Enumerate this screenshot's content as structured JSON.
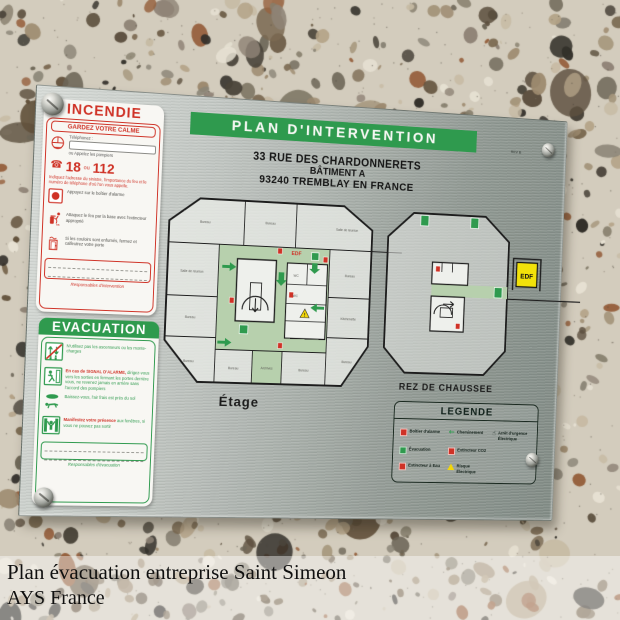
{
  "caption": {
    "line1": "Plan évacuation entreprise Saint Simeon",
    "line2": "AYS France"
  },
  "plate": {
    "title": "PLAN D'INTERVENTION",
    "rev": "REV B",
    "address": {
      "line1": "33 RUE DES CHARDONNERETS",
      "line2": "BÂTIMENT A",
      "line3": "93240 TREMBLAY EN FRANCE"
    },
    "incendie": {
      "title": "INCENDIE",
      "subtitle": "GARDEZ VOTRE CALME",
      "phone_label": "Téléphonez :",
      "phone_value": "",
      "call_label": "ou Appelez les pompiers",
      "num1": "18",
      "num_sep": "ou",
      "num2": "112",
      "notice": "Indiquez l'adresse du sinistre, l'importance du feu et le numéro de téléphone d'où l'on vous appelle.",
      "steps": [
        {
          "icon": "alarm-button-icon",
          "text": "Appuyez sur le boîtier d'alarme"
        },
        {
          "icon": "fire-extinguisher-icon",
          "text": "Attaquez le feu par la base avec l'extincteur approprié"
        },
        {
          "icon": "closed-door-icon",
          "text": "Si les couloirs sont enfumés, fermez et calfeutrez votre porte"
        }
      ],
      "footer": "Responsables d'intervention"
    },
    "evacuation": {
      "title": "EVACUATION",
      "steps": [
        {
          "icon": "no-elevator-icon",
          "lead": "",
          "text": "N'utilisez pas les ascenseurs ou les monte-charges"
        },
        {
          "icon": "emergency-exit-icon",
          "lead": "En cas de SIGNAL D'ALARME,",
          "text": "dirigez-vous vers les sorties en fermant les portes derrière vous, ne revenez jamais en arrière sans l'accord des pompiers"
        },
        {
          "icon": "crawl-low-icon",
          "lead": "",
          "text": "Baissez-vous, l'air frais est près du sol"
        },
        {
          "icon": "window-presence-icon",
          "lead": "Manifestez votre présence",
          "text": "aux fenêtres, si vous ne pouvez pas sortir"
        }
      ],
      "footer": "Responsables d'évacuation"
    },
    "floors": {
      "etage": {
        "label": "Étage",
        "edf_label": "EDF",
        "rooms": [
          "Bureau",
          "Bureau",
          "Salle de réunion",
          "Salle de réunion",
          "Bureau",
          "Bureau",
          "Kitchenette",
          "Bureau",
          "Bureau",
          "Bureau",
          "Bureau",
          "Archives",
          "WC",
          "WC"
        ]
      },
      "rdc": {
        "label": "REZ DE CHAUSSEE",
        "edf_label": "EDF"
      }
    },
    "legend": {
      "title": "LEGENDE",
      "items": [
        {
          "icon": "alarm-box-icon",
          "label": "Boîtier d'alarme"
        },
        {
          "icon": "evacuation-icon",
          "label": "Évacuation"
        },
        {
          "icon": "water-extinguisher-icon",
          "label": "Extincteur à Eau"
        },
        {
          "icon": "path-arrow-icon",
          "label": "Cheminement"
        },
        {
          "icon": "co2-extinguisher-icon",
          "label": "Extincteur CO2"
        },
        {
          "icon": "electric-hazard-icon",
          "label": "Risque Électrique"
        },
        {
          "icon": "emergency-stop-icon",
          "label": "Arrêt d'urgence Électrique"
        }
      ]
    },
    "colors": {
      "green": "#2f9a4e",
      "red": "#cf3226",
      "corridor_green": "#b7d0ad",
      "edf_yellow": "#f2e20a"
    }
  }
}
